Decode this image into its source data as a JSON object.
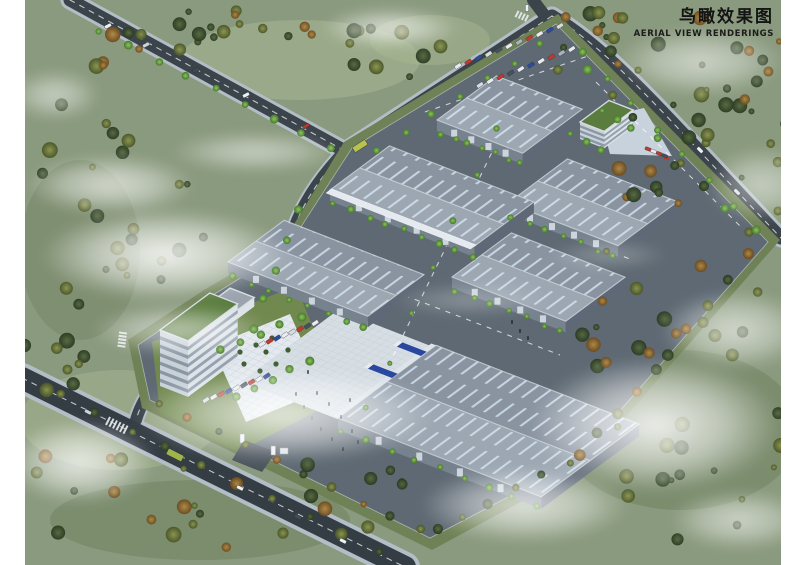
{
  "title": {
    "zh": "鸟瞰效果图",
    "en": "AERIAL VIEW RENDERINGS"
  },
  "palette": {
    "terrain": "#8a9a7e",
    "site_ground": "#5e6973",
    "road_asphalt": "#3b434b",
    "sidewalk": "#b3bdc5",
    "roof_light": "#9ca7b2",
    "roof_dark": "#8a94a1",
    "skylight_stripe": "#d8e9f6",
    "facade_sun": "#77828f",
    "facade_shade": "#5e6876",
    "green_roof": "#5a7c3e",
    "concrete_yard": "#d6dee4",
    "apron": "#c7d2dc",
    "truck_blue": "#2a47a0",
    "tree_bright": "#6faf4e",
    "tree_dark": "#3f5436",
    "tree_olive": "#7c8747",
    "tree_autumn": "#a07838",
    "cloud": "#ffffff"
  },
  "scene": {
    "buildings": [
      {
        "id": "warehouse-1",
        "type": "warehouse",
        "anchor": [
          437,
          120
        ],
        "len": 92,
        "dep": 74,
        "f": 11
      },
      {
        "id": "dormitory-block",
        "type": "green",
        "anchor": [
          580,
          122
        ],
        "len": 26,
        "dep": 36,
        "f": 17
      },
      {
        "id": "warehouse-4",
        "type": "warehouse",
        "anchor": [
          508,
          203
        ],
        "len": 118,
        "dep": 74,
        "f": 11
      },
      {
        "id": "warehouse-2",
        "type": "warehouse",
        "anchor": [
          330,
          190
        ],
        "len": 155,
        "dep": 74,
        "f": 11,
        "canopy": true
      },
      {
        "id": "warehouse-5",
        "type": "warehouse",
        "anchor": [
          452,
          277
        ],
        "len": 122,
        "dep": 74,
        "f": 11
      },
      {
        "id": "warehouse-3",
        "type": "warehouse",
        "anchor": [
          228,
          262
        ],
        "len": 150,
        "dep": 70,
        "f": 11
      },
      {
        "id": "office-annex",
        "type": "annex",
        "anchor": [
          206,
          306
        ],
        "len": 26,
        "dep": 30,
        "f": 9
      },
      {
        "id": "office-tower",
        "type": "tower",
        "anchor": [
          160,
          330
        ],
        "len": 30,
        "dep": 62,
        "f": 56
      },
      {
        "id": "warehouse-6",
        "type": "warehouse",
        "anchor": [
          338,
          418
        ],
        "len": 218,
        "dep": 122,
        "f": 12,
        "dock": true
      }
    ],
    "car_rows": [
      {
        "id": "parking-row-north-1",
        "start": [
          458,
          66
        ],
        "step": [
          10.2,
          -4.0
        ],
        "n": 11,
        "angle": -33,
        "w": 7,
        "h": 3.6,
        "colors": [
          "#e9ebee",
          "#c0392b",
          "#2c4b9e",
          "#d9dcdf",
          "#47505c",
          "#e9ebee",
          "#aab2ba",
          "#c0392b",
          "#e9ebee",
          "#2c4b9e",
          "#d9dcdf"
        ]
      },
      {
        "id": "parking-row-north-2",
        "start": [
          480,
          85
        ],
        "step": [
          10.2,
          -4.0
        ],
        "n": 10,
        "angle": -33,
        "w": 7,
        "h": 3.6,
        "colors": [
          "#d9dcdf",
          "#e9ebee",
          "#c0392b",
          "#47505c",
          "#e9ebee",
          "#2c4b9e",
          "#e9ebee",
          "#c0392b",
          "#aab2ba",
          "#e9ebee"
        ]
      },
      {
        "id": "parking-row-dorm",
        "start": [
          648,
          149
        ],
        "step": [
          5.6,
          2.3
        ],
        "n": 4,
        "angle": 21,
        "w": 6,
        "h": 3.2,
        "colors": [
          "#c0392b",
          "#e9ebee",
          "#c0392b",
          "#47505c"
        ]
      },
      {
        "id": "parking-row-office-1",
        "start": [
          262,
          344
        ],
        "step": [
          7.6,
          -3.0
        ],
        "n": 8,
        "angle": 57,
        "w": 3.8,
        "h": 7,
        "colors": [
          "#e9ebee",
          "#c0392b",
          "#2c4b9e",
          "#e9ebee",
          "#d9dcdf",
          "#c0392b",
          "#47505c",
          "#e9ebee"
        ]
      },
      {
        "id": "parking-row-office-2",
        "start": [
          206,
          400
        ],
        "step": [
          7.6,
          -3.0
        ],
        "n": 9,
        "angle": 57,
        "w": 3.8,
        "h": 7,
        "colors": [
          "#d9dcdf",
          "#e9ebee",
          "#c0392b",
          "#2c4b9e",
          "#e9ebee",
          "#47505c",
          "#c0392b",
          "#e9ebee",
          "#2c4b9e"
        ]
      }
    ],
    "vehicles": [
      {
        "id": "bus",
        "x": 360,
        "y": 146,
        "w": 15,
        "h": 6,
        "angle": -33,
        "color": "#b9c24e"
      },
      {
        "id": "bus",
        "x": 175,
        "y": 455,
        "w": 17,
        "h": 6.5,
        "angle": 27,
        "color": "#9fb54a"
      },
      {
        "id": "car",
        "x": 108,
        "y": 26,
        "w": 7,
        "h": 3.5,
        "angle": -27,
        "color": "#eef1f3"
      },
      {
        "id": "car",
        "x": 146,
        "y": 45,
        "w": 7,
        "h": 3.5,
        "angle": -27,
        "color": "#cfd4d8"
      },
      {
        "id": "car",
        "x": 196,
        "y": 70,
        "w": 7,
        "h": 3.5,
        "angle": -27,
        "color": "#3f4854"
      },
      {
        "id": "car",
        "x": 246,
        "y": 95,
        "w": 7,
        "h": 3.5,
        "angle": -27,
        "color": "#eef1f3"
      },
      {
        "id": "car",
        "x": 306,
        "y": 126,
        "w": 7,
        "h": 3.5,
        "angle": -27,
        "color": "#b03a30"
      },
      {
        "id": "car",
        "x": 700,
        "y": 150,
        "w": 7,
        "h": 3.5,
        "angle": 45,
        "color": "#eef1f3"
      },
      {
        "id": "car",
        "x": 737,
        "y": 192,
        "w": 7,
        "h": 3.5,
        "angle": 45,
        "color": "#dfe4e8"
      },
      {
        "id": "car",
        "x": 240,
        "y": 488,
        "w": 7,
        "h": 3.5,
        "angle": 27,
        "color": "#eef1f3"
      },
      {
        "id": "car",
        "x": 298,
        "y": 517,
        "w": 7,
        "h": 3.5,
        "angle": 27,
        "color": "#454d58"
      },
      {
        "id": "car",
        "x": 343,
        "y": 541,
        "w": 7,
        "h": 3.5,
        "angle": 27,
        "color": "#eef1f3"
      },
      {
        "id": "car",
        "x": 88,
        "y": 412,
        "w": 7,
        "h": 3.5,
        "angle": 27,
        "color": "#cfd4d8"
      },
      {
        "id": "car",
        "x": 527,
        "y": 8,
        "w": 3.5,
        "h": 7,
        "angle": 0,
        "color": "#eef1f3"
      }
    ],
    "tree_lines": [
      {
        "x1": 442,
        "y1": 134,
        "x2": 520,
        "y2": 163,
        "n": 7,
        "r": 3,
        "kinds": [
          "bright"
        ]
      },
      {
        "x1": 334,
        "y1": 204,
        "x2": 472,
        "y2": 257,
        "n": 9,
        "r": 3,
        "kinds": [
          "bright"
        ]
      },
      {
        "x1": 232,
        "y1": 276,
        "x2": 365,
        "y2": 327,
        "n": 8,
        "r": 3,
        "kinds": [
          "bright"
        ]
      },
      {
        "x1": 512,
        "y1": 217,
        "x2": 613,
        "y2": 256,
        "n": 7,
        "r": 3,
        "kinds": [
          "bright"
        ]
      },
      {
        "x1": 456,
        "y1": 291,
        "x2": 560,
        "y2": 331,
        "n": 7,
        "r": 3,
        "kinds": [
          "bright"
        ]
      },
      {
        "x1": 342,
        "y1": 432,
        "x2": 536,
        "y2": 506,
        "n": 9,
        "r": 3,
        "kinds": [
          "bright"
        ]
      },
      {
        "x1": 565,
        "y1": 48,
        "x2": 748,
        "y2": 232,
        "n": 9,
        "r": 4,
        "kinds": [
          "dark",
          "bright",
          "olive"
        ]
      },
      {
        "x1": 750,
        "y1": 252,
        "x2": 666,
        "y2": 356,
        "n": 5,
        "r": 4.5,
        "kinds": [
          "autumn",
          "dark",
          "olive"
        ]
      },
      {
        "x1": 658,
        "y1": 368,
        "x2": 578,
        "y2": 456,
        "n": 5,
        "r": 4.5,
        "kinds": [
          "dark",
          "autumn",
          "olive"
        ]
      },
      {
        "x1": 570,
        "y1": 462,
        "x2": 436,
        "y2": 530,
        "n": 6,
        "r": 4,
        "kinds": [
          "olive",
          "dark"
        ]
      },
      {
        "x1": 420,
        "y1": 530,
        "x2": 160,
        "y2": 405,
        "n": 10,
        "r": 4,
        "kinds": [
          "olive",
          "dark",
          "autumn"
        ]
      },
      {
        "x1": 100,
        "y1": 32,
        "x2": 330,
        "y2": 148,
        "n": 9,
        "r": 3.5,
        "kinds": [
          "bright"
        ]
      },
      {
        "x1": 378,
        "y1": 150,
        "x2": 540,
        "y2": 44,
        "n": 7,
        "r": 3.5,
        "kinds": [
          "bright"
        ]
      },
      {
        "x1": 582,
        "y1": 52,
        "x2": 758,
        "y2": 230,
        "n": 8,
        "r": 3.5,
        "kinds": [
          "bright"
        ]
      },
      {
        "x1": 606,
        "y1": 36,
        "x2": 776,
        "y2": 212,
        "n": 6,
        "r": 3.5,
        "kinds": [
          "dark",
          "olive"
        ]
      },
      {
        "x1": 300,
        "y1": 208,
        "x2": 252,
        "y2": 330,
        "n": 5,
        "r": 3.5,
        "kinds": [
          "bright"
        ]
      },
      {
        "x1": 60,
        "y1": 395,
        "x2": 380,
        "y2": 553,
        "n": 10,
        "r": 4,
        "kinds": [
          "olive",
          "dark"
        ]
      },
      {
        "x1": 222,
        "y1": 348,
        "x2": 300,
        "y2": 318,
        "n": 5,
        "r": 3.5,
        "kinds": [
          "bright"
        ]
      },
      {
        "x1": 238,
        "y1": 395,
        "x2": 308,
        "y2": 362,
        "n": 5,
        "r": 3.5,
        "kinds": [
          "bright"
        ]
      },
      {
        "x1": 572,
        "y1": 135,
        "x2": 600,
        "y2": 150,
        "n": 3,
        "r": 3,
        "kinds": [
          "bright"
        ]
      },
      {
        "x1": 604,
        "y1": 112,
        "x2": 630,
        "y2": 128,
        "n": 3,
        "r": 3,
        "kinds": [
          "bright"
        ]
      },
      {
        "x1": 498,
        "y1": 128,
        "x2": 366,
        "y2": 408,
        "n": 7,
        "r": 3,
        "kinds": [
          "bright"
        ]
      }
    ],
    "tree_clusters": [
      {
        "cx": 200,
        "cy": 38,
        "rx": 115,
        "ry": 32,
        "n": 22,
        "seed": 7,
        "kinds": [
          "dark",
          "olive",
          "autumn"
        ]
      },
      {
        "cx": 140,
        "cy": 235,
        "rx": 70,
        "ry": 55,
        "n": 14,
        "seed": 11,
        "kinds": [
          "dark",
          "olive"
        ]
      },
      {
        "cx": 398,
        "cy": 52,
        "rx": 55,
        "ry": 26,
        "n": 10,
        "seed": 13,
        "kinds": [
          "dark",
          "olive"
        ]
      },
      {
        "cx": 636,
        "cy": 38,
        "rx": 85,
        "ry": 32,
        "n": 14,
        "seed": 17,
        "kinds": [
          "dark",
          "autumn",
          "olive"
        ]
      },
      {
        "cx": 735,
        "cy": 115,
        "rx": 55,
        "ry": 48,
        "n": 12,
        "seed": 19,
        "kinds": [
          "dark",
          "olive"
        ]
      },
      {
        "cx": 668,
        "cy": 312,
        "rx": 95,
        "ry": 62,
        "n": 18,
        "seed": 23,
        "kinds": [
          "dark",
          "olive",
          "autumn"
        ]
      },
      {
        "cx": 700,
        "cy": 478,
        "rx": 85,
        "ry": 68,
        "n": 16,
        "seed": 29,
        "kinds": [
          "dark",
          "olive"
        ]
      },
      {
        "cx": 220,
        "cy": 502,
        "rx": 190,
        "ry": 48,
        "n": 26,
        "seed": 31,
        "kinds": [
          "dark",
          "olive",
          "autumn"
        ]
      },
      {
        "cx": 55,
        "cy": 320,
        "rx": 32,
        "ry": 75,
        "n": 10,
        "seed": 37,
        "kinds": [
          "dark",
          "olive"
        ]
      },
      {
        "cx": 652,
        "cy": 182,
        "rx": 38,
        "ry": 22,
        "n": 8,
        "seed": 41,
        "kinds": [
          "autumn",
          "dark"
        ]
      },
      {
        "cx": 80,
        "cy": 140,
        "rx": 50,
        "ry": 40,
        "n": 8,
        "seed": 43,
        "kinds": [
          "dark",
          "olive"
        ]
      },
      {
        "cx": 755,
        "cy": 60,
        "rx": 35,
        "ry": 45,
        "n": 8,
        "seed": 47,
        "kinds": [
          "dark",
          "autumn"
        ]
      }
    ],
    "people": [
      [
        296,
        394
      ],
      [
        304,
        407
      ],
      [
        312,
        418
      ],
      [
        321,
        429
      ],
      [
        332,
        439
      ],
      [
        343,
        449
      ],
      [
        352,
        431
      ],
      [
        341,
        417
      ],
      [
        329,
        404
      ],
      [
        317,
        393
      ],
      [
        350,
        400
      ],
      [
        358,
        442
      ],
      [
        512,
        322
      ],
      [
        520,
        331
      ],
      [
        528,
        338
      ],
      [
        308,
        372
      ]
    ],
    "crosswalks": [
      {
        "x": 108,
        "y": 421,
        "n": 6,
        "dx": 3.5,
        "dy": 1.73,
        "w": 2,
        "h": 9,
        "angle": 27
      },
      {
        "x": 123,
        "y": 333,
        "n": 5,
        "dx": -0.4,
        "dy": 3.3,
        "w": 8,
        "h": 2,
        "angle": 8
      },
      {
        "x": 517,
        "y": 14,
        "n": 4,
        "dx": 3.2,
        "dy": 1.4,
        "w": 2,
        "h": 7,
        "angle": 27
      }
    ],
    "shrub_ring": [
      [
        240,
        352
      ],
      [
        256,
        345
      ],
      [
        272,
        338
      ],
      [
        288,
        350
      ],
      [
        276,
        364
      ],
      [
        260,
        371
      ],
      [
        244,
        364
      ],
      [
        266,
        352
      ]
    ]
  }
}
